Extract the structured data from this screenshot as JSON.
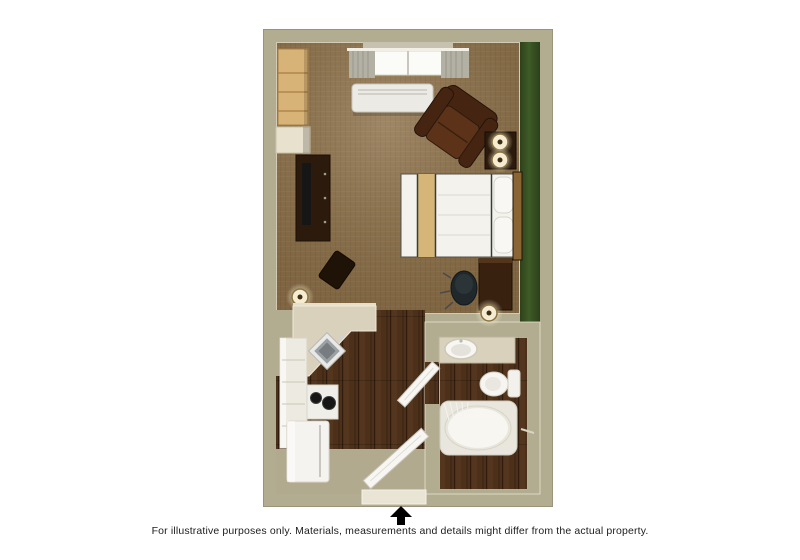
{
  "caption": {
    "text": "For illustrative purposes only.  Materials, measurements and details might differ from the actual property."
  },
  "entrance_arrow": {
    "direction": "up",
    "color": "#000000"
  },
  "palette": {
    "page_bg": "#ffffff",
    "text": "#1d1d1d",
    "arrow": "#000000",
    "wall": "#b2ad90",
    "wall_edge": "#98937a",
    "wall_line": "#e7e3d2",
    "recess": "#c6c2af",
    "green": "#3e5b26",
    "carpet": "#8d7048",
    "wood": "#4c3019",
    "wood_light": "#66452a",
    "wood_dark": "#2f1c0e",
    "khaki_floor": "#b2aa8e",
    "white_obj": "#f3f2ec",
    "cream": "#d9d1bc",
    "cream_light": "#e7dfca",
    "light_wood": "#d7b377",
    "light_wood_line": "#a87f44",
    "dark_furn": "#2c1b0c",
    "dark_furn2": "#1f1206",
    "chair": "#452512",
    "chair_light": "#5c3319",
    "tan": "#d5b678",
    "headboard": "#8a6433",
    "curtain": "#b3b0a4",
    "metal": "#9aa0a3",
    "metal_dark": "#767c80",
    "glow": "#f5ecd2",
    "lamp_ring": "#8a7440",
    "lamp_dot": "#3e2f12",
    "black_obj": "#161616",
    "office_chair": "#20282b",
    "ac": "#ebeae4"
  },
  "floorplan": {
    "type": "studio-suite-top-down-3d-render",
    "rooms": [
      {
        "name": "bedroom-living-area",
        "floor": "brown-carpet",
        "accent_wall": "green-right"
      },
      {
        "name": "kitchen",
        "floor": "dark-wood-planks"
      },
      {
        "name": "bathroom",
        "floor": "dark-wood-planks"
      },
      {
        "name": "entry",
        "floor": "tan"
      }
    ],
    "furniture": [
      "window-with-curtains",
      "ptac-ac-unit",
      "closet-shelving",
      "storage-shelf",
      "tv-console",
      "accent-ottoman",
      "floor-lamp",
      "armchair",
      "side-table",
      "table-lamp-pair",
      "bed",
      "desk",
      "office-chair",
      "desk-lamp",
      "kitchen-counter-with-corner-sink",
      "tall-cabinets",
      "stove-cooktop",
      "refrigerator",
      "entry-door",
      "bathroom-door",
      "vanity-sink",
      "toilet",
      "bathtub-with-shower-curtain"
    ]
  }
}
